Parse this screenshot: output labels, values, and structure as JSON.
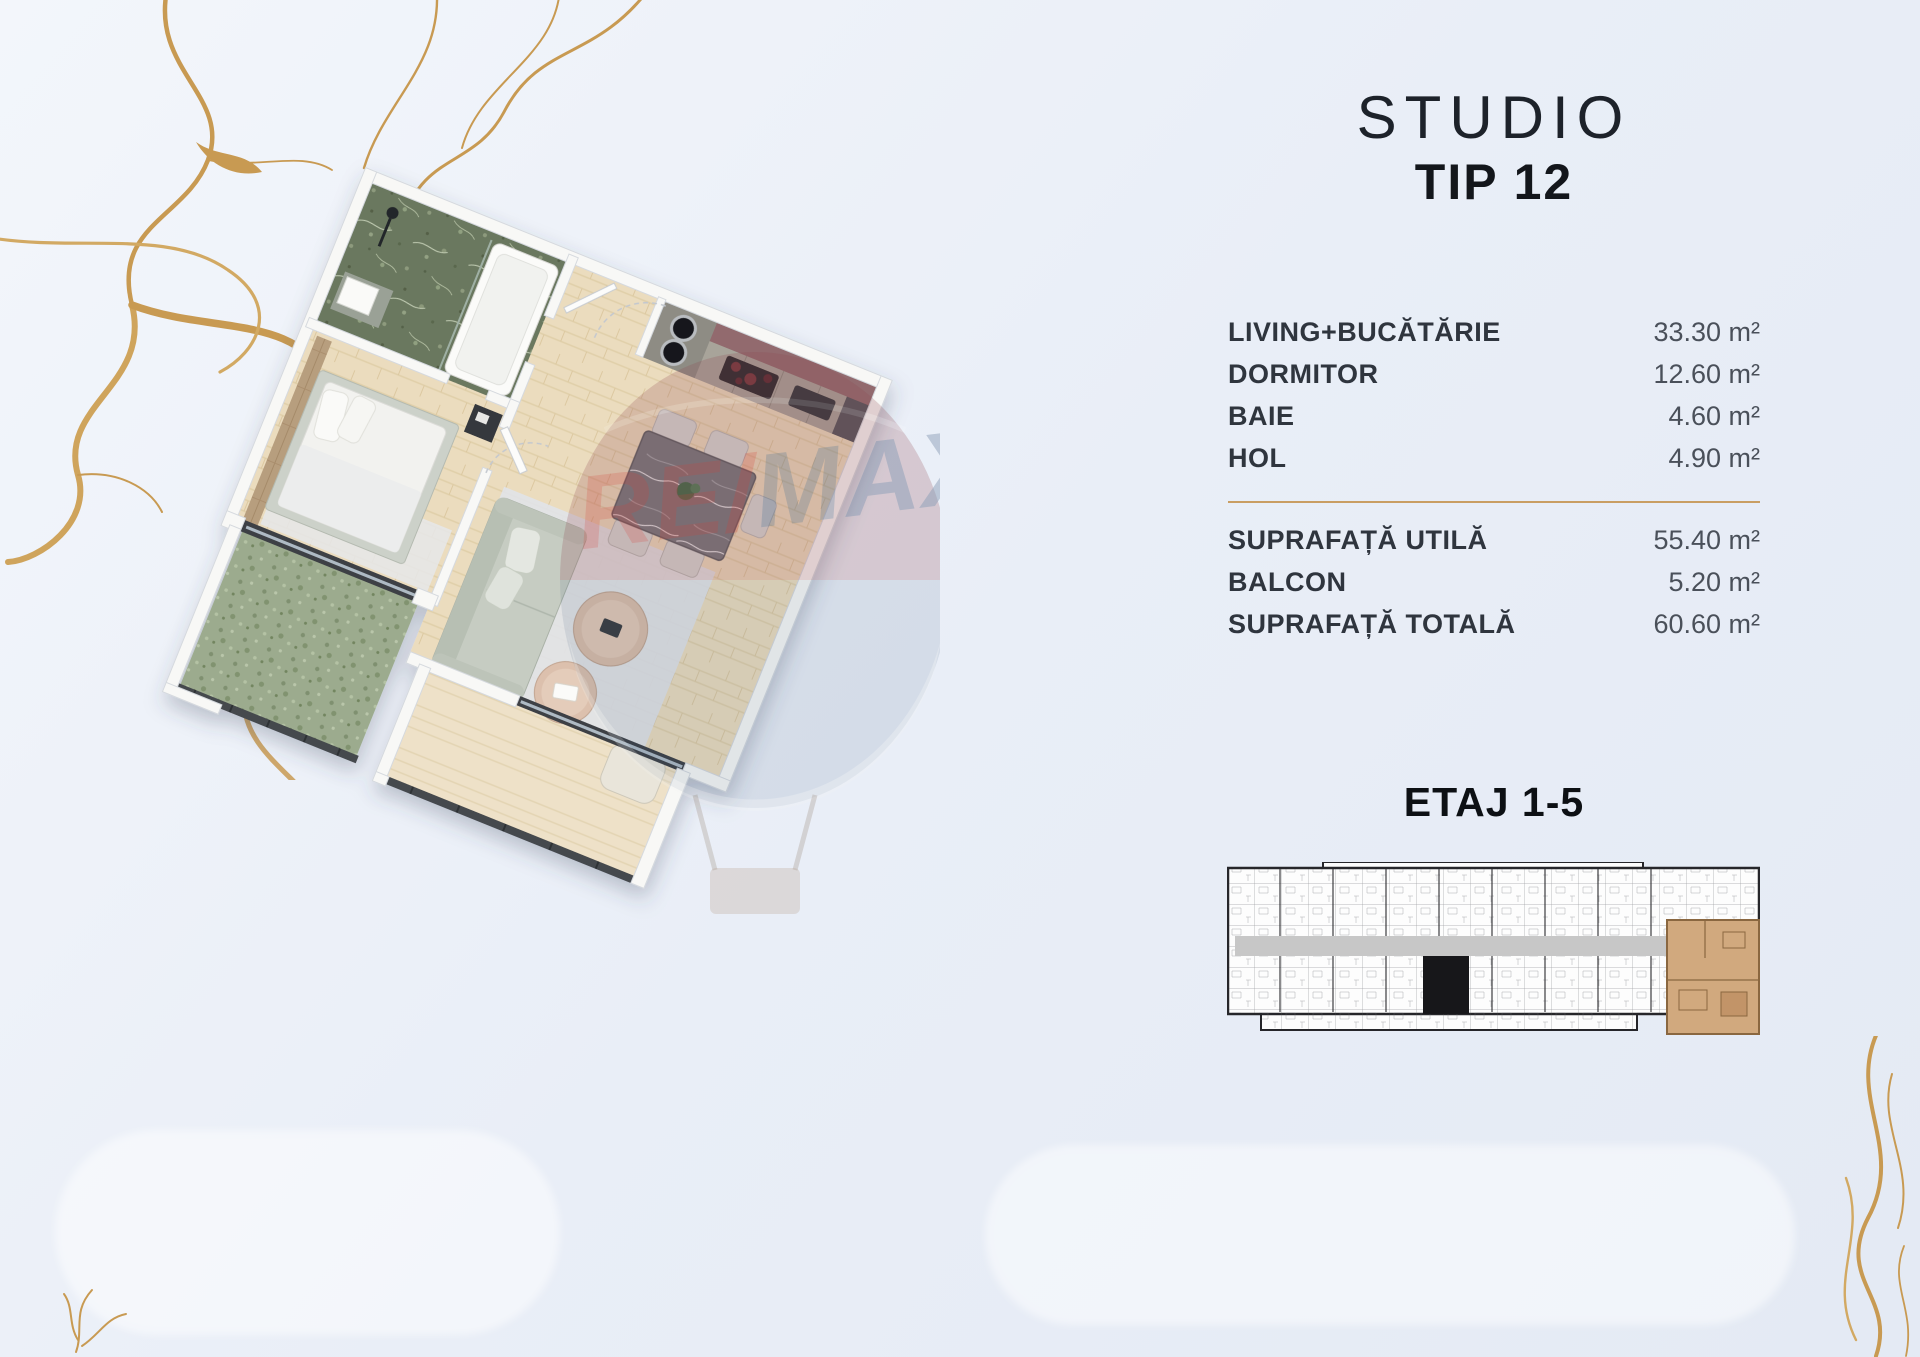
{
  "title": {
    "line1": "STUDIO",
    "line2": "TIP 12"
  },
  "areas": {
    "rooms": [
      {
        "label": "LIVING+BUCĂTĂRIE",
        "value": "33.30 m²"
      },
      {
        "label": "DORMITOR",
        "value": "12.60 m²"
      },
      {
        "label": "BAIE",
        "value": "4.60 m²"
      },
      {
        "label": "HOL",
        "value": "4.90 m²"
      }
    ],
    "totals": [
      {
        "label": "SUPRAFAȚĂ UTILĂ",
        "value": "55.40 m²"
      },
      {
        "label": "BALCON",
        "value": "5.20 m²"
      },
      {
        "label": "SUPRAFAȚĂ TOTALĂ",
        "value": "60.60 m²"
      }
    ]
  },
  "floor": {
    "label": "ETAJ 1-5"
  },
  "watermark": {
    "brand": "RE/MAX",
    "part_re": "RE",
    "part_slash": "/",
    "part_max": "MAX"
  },
  "building_plan": {
    "highlighted_unit": "Studio Tip 12 (etaj 1-5, capăt dreapta-jos)"
  },
  "colors": {
    "accent_gold": "#c89a52",
    "divider_gold": "#c99e63",
    "highlight_unit_tan": "#d1a97e",
    "text_dark": "#2f353e",
    "text_value": "#4a505a",
    "background": "#e9eef7"
  }
}
